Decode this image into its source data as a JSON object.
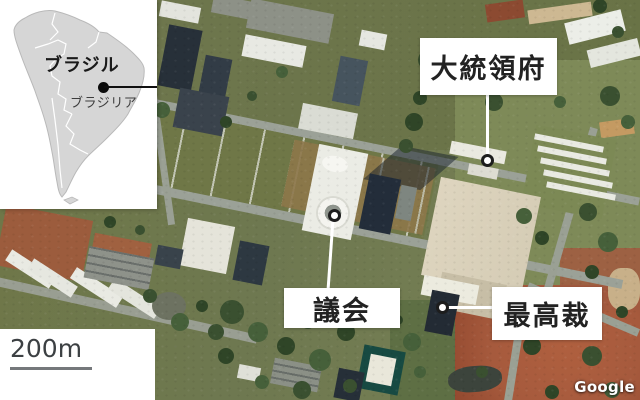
{
  "inset_map": {
    "country_label": "ブラジル",
    "city_label": "ブラジリア"
  },
  "map_labels": {
    "presidential_office": "大統領府",
    "parliament": "議会",
    "supreme_court": "最高裁"
  },
  "scale_bar": {
    "label": "200m"
  },
  "attribution": {
    "label": "Google"
  },
  "colors": {
    "grass": "#6f7747",
    "road": "#9ba197",
    "plaza": "#d5ccb5",
    "dirt_red": "#a65a3d",
    "tree_dark": "#31492b",
    "continent": "#d6d6d6",
    "label_text": "#222222"
  }
}
